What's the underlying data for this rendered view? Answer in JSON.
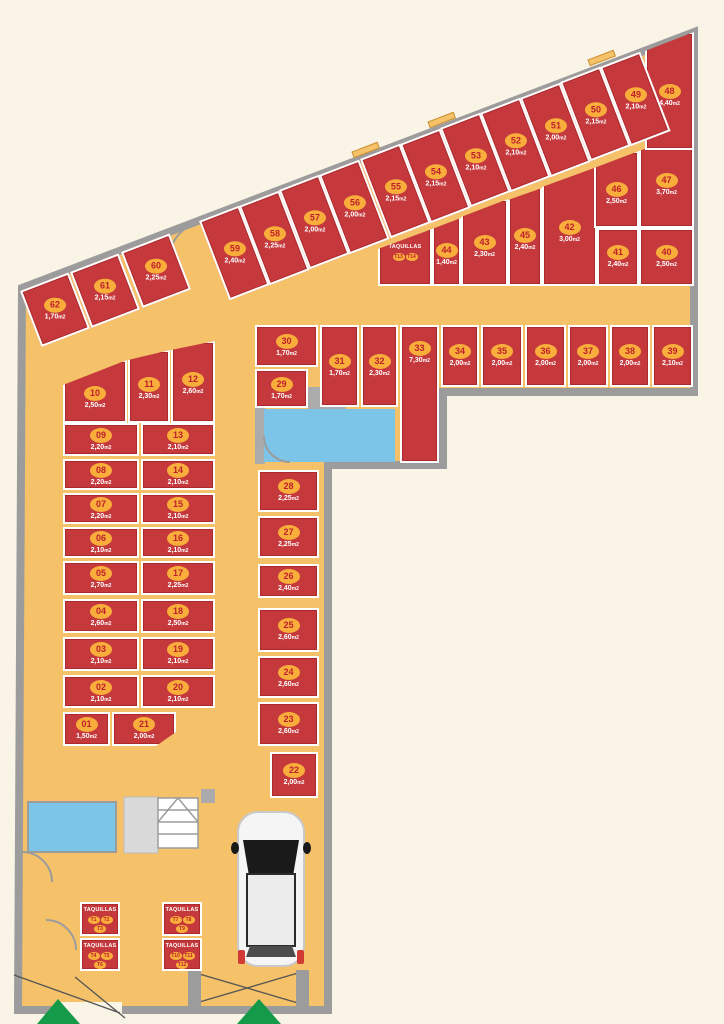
{
  "plan": {
    "type": "parking-storage-floor-plan",
    "size_suffix": "m2",
    "lockers_label": "TAQUILLAS"
  },
  "colors": {
    "unit_red": "#C5393D",
    "floor_orange": "#F5C169",
    "wall_gray": "#9C9C9C",
    "badge_orange": "#F9AE3B",
    "badge_text_red": "#BE1E2D",
    "elevator_blue": "#7CC4E8",
    "arrow_green": "#149A49",
    "background_cream": "#FAF4E7"
  },
  "units": [
    {
      "id": "01",
      "size": "1,50",
      "x": 63,
      "y": 712,
      "w": 47,
      "h": 34
    },
    {
      "id": "02",
      "size": "2,10",
      "x": 63,
      "y": 675,
      "w": 76,
      "h": 33
    },
    {
      "id": "03",
      "size": "2,10",
      "x": 63,
      "y": 637,
      "w": 76,
      "h": 34
    },
    {
      "id": "04",
      "size": "2,60",
      "x": 63,
      "y": 599,
      "w": 76,
      "h": 34
    },
    {
      "id": "05",
      "size": "2,70",
      "x": 63,
      "y": 561,
      "w": 76,
      "h": 34
    },
    {
      "id": "06",
      "size": "2,10",
      "x": 63,
      "y": 527,
      "w": 76,
      "h": 31
    },
    {
      "id": "07",
      "size": "2,20",
      "x": 63,
      "y": 493,
      "w": 76,
      "h": 31
    },
    {
      "id": "08",
      "size": "2,20",
      "x": 63,
      "y": 459,
      "w": 76,
      "h": 31
    },
    {
      "id": "09",
      "size": "2,20",
      "x": 63,
      "y": 423,
      "w": 76,
      "h": 33
    },
    {
      "id": "10",
      "size": "2,50",
      "x": 63,
      "y": 360,
      "w": 64,
      "h": 63,
      "cut": [
        25,
        0
      ]
    },
    {
      "id": "11",
      "size": "2,30",
      "x": 128,
      "y": 350,
      "w": 42,
      "h": 73,
      "cut": [
        10,
        0
      ]
    },
    {
      "id": "12",
      "size": "2,60",
      "x": 171,
      "y": 341,
      "w": 44,
      "h": 82,
      "cut": [
        9,
        0
      ]
    },
    {
      "id": "13",
      "size": "2,10",
      "x": 141,
      "y": 423,
      "w": 74,
      "h": 33
    },
    {
      "id": "14",
      "size": "2,10",
      "x": 141,
      "y": 459,
      "w": 74,
      "h": 31
    },
    {
      "id": "15",
      "size": "2,10",
      "x": 141,
      "y": 493,
      "w": 74,
      "h": 31
    },
    {
      "id": "16",
      "size": "2,10",
      "x": 141,
      "y": 527,
      "w": 74,
      "h": 31
    },
    {
      "id": "17",
      "size": "2,25",
      "x": 141,
      "y": 561,
      "w": 74,
      "h": 34
    },
    {
      "id": "18",
      "size": "2,50",
      "x": 141,
      "y": 599,
      "w": 74,
      "h": 34
    },
    {
      "id": "19",
      "size": "2,10",
      "x": 141,
      "y": 637,
      "w": 74,
      "h": 34
    },
    {
      "id": "20",
      "size": "2,10",
      "x": 141,
      "y": 675,
      "w": 74,
      "h": 33
    },
    {
      "id": "21",
      "size": "2,00",
      "x": 112,
      "y": 712,
      "w": 64,
      "h": 34,
      "cutbr": [
        20,
        14
      ]
    },
    {
      "id": "22",
      "size": "2,00",
      "x": 270,
      "y": 752,
      "w": 48,
      "h": 46
    },
    {
      "id": "23",
      "size": "2,60",
      "x": 258,
      "y": 702,
      "w": 61,
      "h": 44
    },
    {
      "id": "24",
      "size": "2,60",
      "x": 258,
      "y": 656,
      "w": 61,
      "h": 42
    },
    {
      "id": "25",
      "size": "2,60",
      "x": 258,
      "y": 608,
      "w": 61,
      "h": 44
    },
    {
      "id": "26",
      "size": "2,40",
      "x": 258,
      "y": 564,
      "w": 61,
      "h": 34
    },
    {
      "id": "27",
      "size": "2,25",
      "x": 258,
      "y": 516,
      "w": 61,
      "h": 42
    },
    {
      "id": "28",
      "size": "2,25",
      "x": 258,
      "y": 470,
      "w": 61,
      "h": 42
    },
    {
      "id": "29",
      "size": "1,70",
      "x": 255,
      "y": 369,
      "w": 53,
      "h": 39
    },
    {
      "id": "30",
      "size": "1,70",
      "x": 255,
      "y": 325,
      "w": 63,
      "h": 42
    },
    {
      "id": "31",
      "size": "1,70",
      "x": 320,
      "y": 325,
      "w": 39,
      "h": 82
    },
    {
      "id": "32",
      "size": "2,30",
      "x": 361,
      "y": 325,
      "w": 37,
      "h": 82
    },
    {
      "id": "33",
      "size": "7,30",
      "x": 400,
      "y": 325,
      "w": 39,
      "h": 138,
      "top": true
    },
    {
      "id": "34",
      "size": "2,00",
      "x": 441,
      "y": 325,
      "w": 38,
      "h": 62
    },
    {
      "id": "35",
      "size": "2,00",
      "x": 481,
      "y": 325,
      "w": 42,
      "h": 62
    },
    {
      "id": "36",
      "size": "2,00",
      "x": 525,
      "y": 325,
      "w": 41,
      "h": 62
    },
    {
      "id": "37",
      "size": "2,00",
      "x": 568,
      "y": 325,
      "w": 40,
      "h": 62
    },
    {
      "id": "38",
      "size": "2,00",
      "x": 610,
      "y": 325,
      "w": 40,
      "h": 62
    },
    {
      "id": "39",
      "size": "2,10",
      "x": 652,
      "y": 325,
      "w": 41,
      "h": 62
    },
    {
      "id": "40",
      "size": "2,50",
      "x": 639,
      "y": 228,
      "w": 55,
      "h": 58
    },
    {
      "id": "41",
      "size": "2,40",
      "x": 597,
      "y": 228,
      "w": 42,
      "h": 58
    },
    {
      "id": "42",
      "size": "3,00",
      "x": 542,
      "y": 166,
      "w": 55,
      "h": 120,
      "cut": [
        21,
        1
      ]
    },
    {
      "id": "43",
      "size": "2,30",
      "x": 461,
      "y": 199,
      "w": 47,
      "h": 87,
      "cut": [
        18,
        0
      ]
    },
    {
      "id": "44",
      "size": "1,40",
      "x": 432,
      "y": 217,
      "w": 29,
      "h": 69,
      "cut": [
        12,
        1
      ]
    },
    {
      "id": "45",
      "size": "2,40",
      "x": 508,
      "y": 187,
      "w": 34,
      "h": 99,
      "cut": [
        13,
        1
      ]
    },
    {
      "id": "46",
      "size": "2,50",
      "x": 594,
      "y": 151,
      "w": 45,
      "h": 77,
      "cut": [
        17,
        0
      ]
    },
    {
      "id": "47",
      "size": "3,70",
      "x": 639,
      "y": 130,
      "w": 55,
      "h": 98,
      "cut": [
        21,
        1
      ]
    },
    {
      "id": "48",
      "size": "4,40",
      "x": 645,
      "y": 32,
      "w": 49,
      "h": 118,
      "cut": [
        19,
        0
      ]
    },
    {
      "id": "49",
      "size": "2,10",
      "x": 600,
      "y": 67,
      "w": 43,
      "h": 85,
      "r": -21
    },
    {
      "id": "50",
      "size": "2,15",
      "x": 560,
      "y": 82,
      "w": 43,
      "h": 85,
      "r": -21
    },
    {
      "id": "51",
      "size": "2,00",
      "x": 520,
      "y": 98,
      "w": 43,
      "h": 85,
      "r": -21
    },
    {
      "id": "52",
      "size": "2,10",
      "x": 480,
      "y": 113,
      "w": 43,
      "h": 85,
      "r": -21
    },
    {
      "id": "53",
      "size": "2,10",
      "x": 440,
      "y": 128,
      "w": 43,
      "h": 85,
      "r": -21
    },
    {
      "id": "54",
      "size": "2,15",
      "x": 400,
      "y": 144,
      "w": 43,
      "h": 85,
      "r": -21
    },
    {
      "id": "55",
      "size": "2,15",
      "x": 360,
      "y": 159,
      "w": 43,
      "h": 85,
      "r": -21
    },
    {
      "id": "56",
      "size": "2,00",
      "x": 319,
      "y": 175,
      "w": 43,
      "h": 85,
      "r": -21
    },
    {
      "id": "57",
      "size": "2,00",
      "x": 279,
      "y": 190,
      "w": 43,
      "h": 85,
      "r": -21
    },
    {
      "id": "58",
      "size": "2,25",
      "x": 239,
      "y": 206,
      "w": 43,
      "h": 85,
      "r": -21
    },
    {
      "id": "59",
      "size": "2,40",
      "x": 199,
      "y": 221,
      "w": 43,
      "h": 85,
      "r": -21
    },
    {
      "id": "60",
      "size": "2,25",
      "x": 121,
      "y": 252,
      "w": 52,
      "h": 60,
      "r": -21
    },
    {
      "id": "61",
      "size": "2,15",
      "x": 70,
      "y": 272,
      "w": 52,
      "h": 60,
      "r": -21
    },
    {
      "id": "62",
      "size": "1,70",
      "x": 20,
      "y": 291,
      "w": 52,
      "h": 60,
      "r": -21
    }
  ],
  "locker_boxes": [
    {
      "label": "TAQUILLAS",
      "tags": [
        "T1",
        "T2",
        "T3"
      ],
      "x": 80,
      "y": 902,
      "w": 40,
      "h": 34
    },
    {
      "label": "TAQUILLAS",
      "tags": [
        "T4",
        "T5",
        "T6"
      ],
      "x": 80,
      "y": 938,
      "w": 40,
      "h": 33
    },
    {
      "label": "TAQUILLAS",
      "tags": [
        "T7",
        "T8",
        "T9"
      ],
      "x": 162,
      "y": 902,
      "w": 40,
      "h": 34
    },
    {
      "label": "TAQUILLAS",
      "tags": [
        "T10",
        "T11",
        "T12"
      ],
      "x": 162,
      "y": 938,
      "w": 40,
      "h": 33
    },
    {
      "label": "TAQUILLAS",
      "tags": [
        "T13",
        "T14"
      ],
      "x": 378,
      "y": 228,
      "w": 54,
      "h": 58,
      "cut": [
        21,
        1
      ],
      "pt": 14
    }
  ]
}
